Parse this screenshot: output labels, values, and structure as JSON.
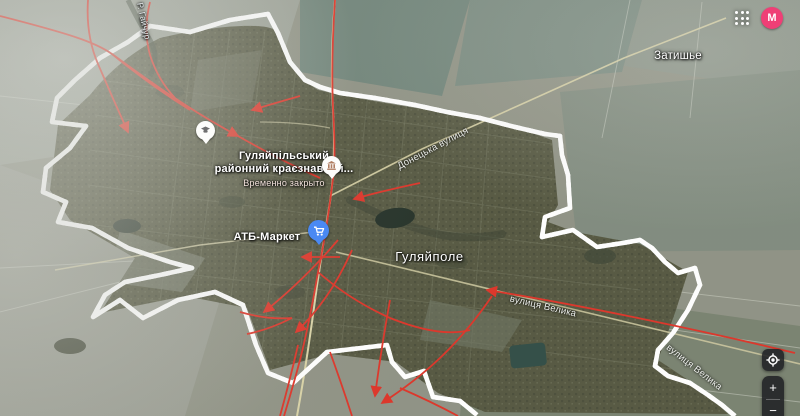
{
  "theme": {
    "perimeter_red": "#e9493c",
    "arrow_red": "#dd3226",
    "avatar_pink": "#ef3f76",
    "control_bg": "rgba(32,33,36,0.88)"
  },
  "header": {
    "avatar_label": "M"
  },
  "map": {
    "labels": {
      "settlement_ne": "Затишье",
      "town": "Гуляйполе",
      "river": "Р. Гайчур",
      "museum_line1": "Гуляйпільський",
      "museum_line2": "районний краєзнавчий...",
      "museum_status": "Временно закрыто",
      "store": "АТБ-Маркет",
      "street_donetska": "Донецька вулиця",
      "street_velyka": "вулиця Велика"
    },
    "annotation": {
      "perimeter_style": "red-white dashed enclosure around town",
      "arrow_color_hex": "#dd3226"
    },
    "controls": {
      "zoom_in": "+",
      "zoom_out": "−"
    }
  }
}
